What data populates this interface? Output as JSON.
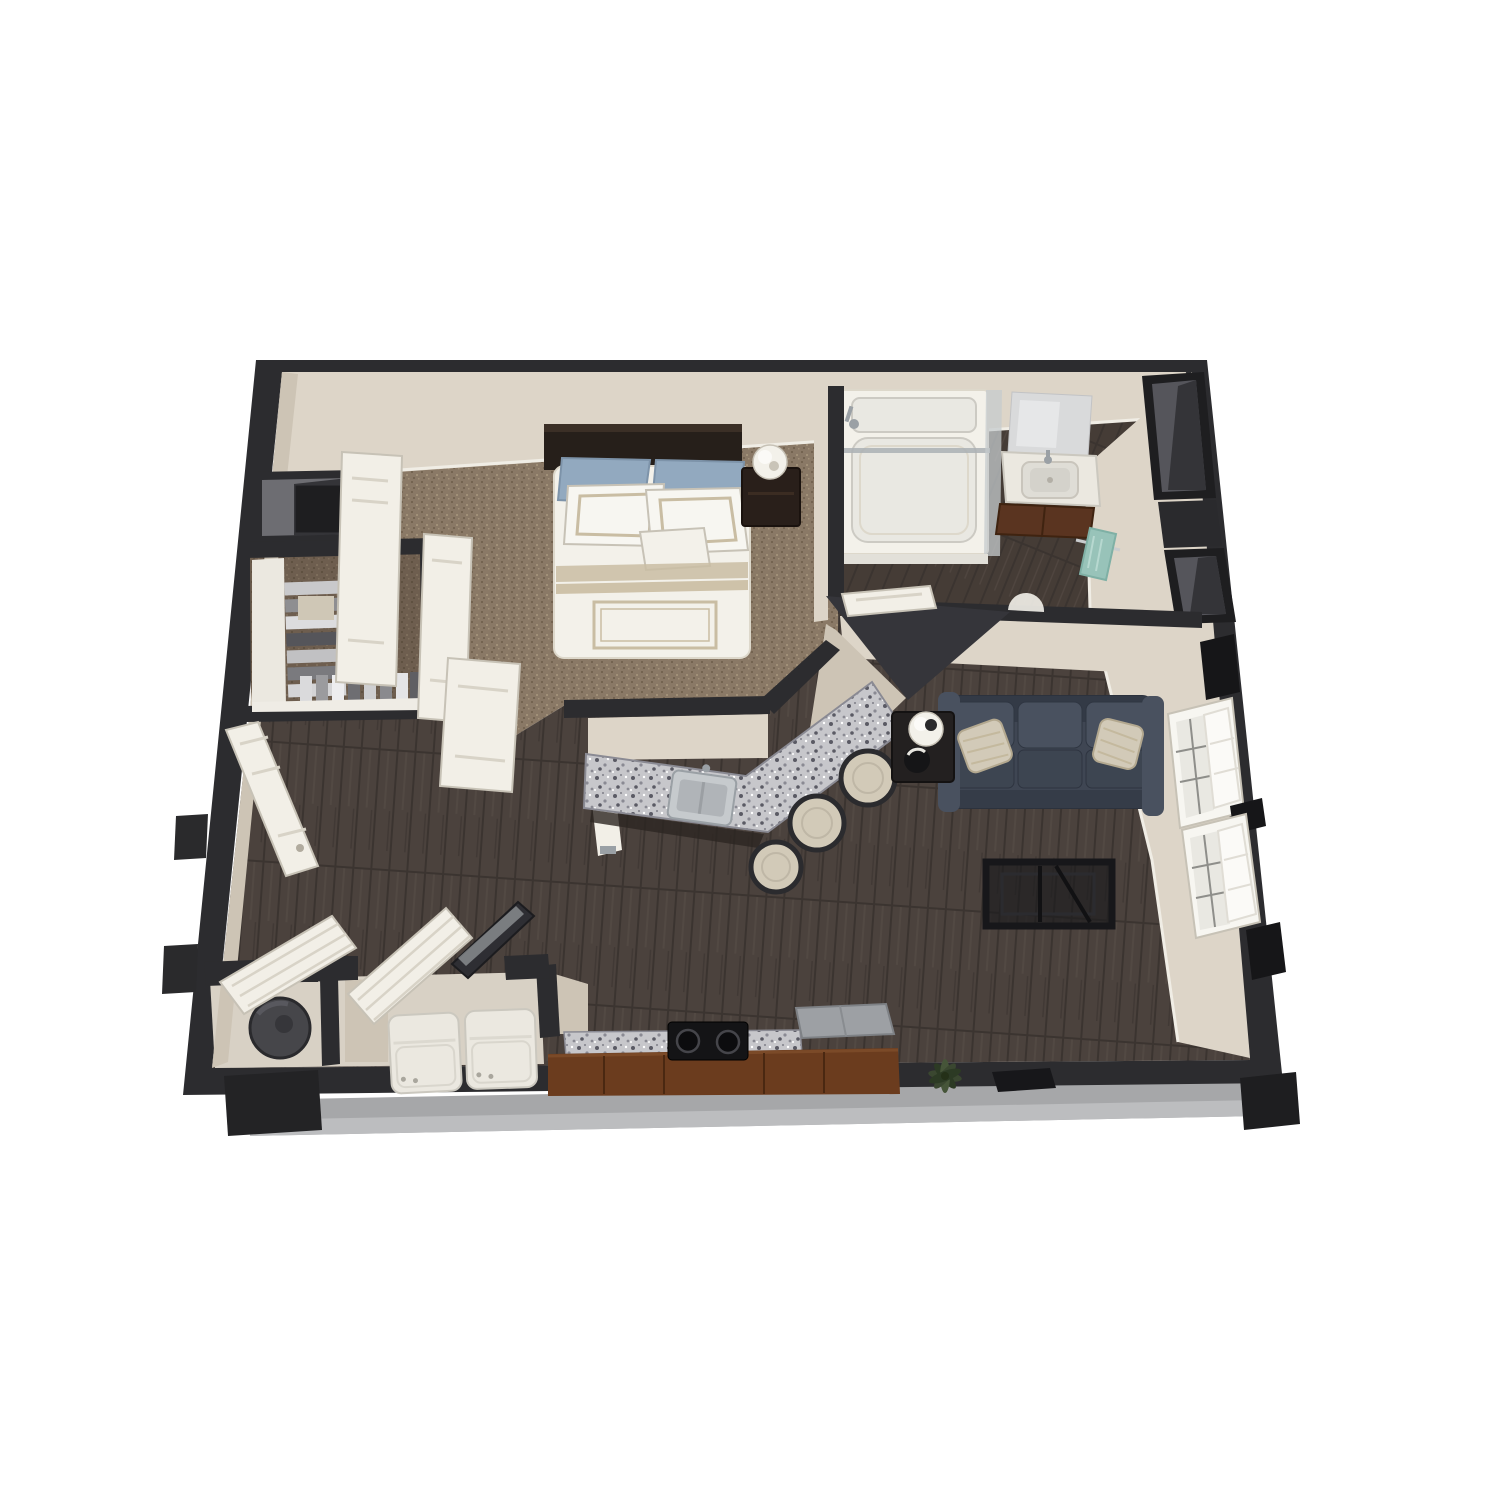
{
  "scene": {
    "type": "3d-floor-plan-render",
    "rooms": [
      "bedroom",
      "walk-in-closet",
      "bathroom",
      "kitchen",
      "living-room",
      "laundry-entry"
    ],
    "furniture": [
      "bed",
      "nightstand",
      "table-lamp",
      "closet-clothes",
      "closet-doors",
      "bathtub-shower",
      "vanity-sink",
      "mirror",
      "towel",
      "wall-niches",
      "breakfast-bar",
      "kitchen-sink",
      "bar-stools",
      "sofa",
      "throw-pillows",
      "side-table",
      "sofa-lamp",
      "decor-bowl",
      "coffee-table",
      "range",
      "refrigerator",
      "washer",
      "dryer",
      "water-heater",
      "louver-doors",
      "glass-door",
      "entry-door",
      "windows",
      "plant",
      "tv-slab",
      "entry-stoop"
    ]
  },
  "colors": {
    "wall": "#2c2c2f",
    "wallDeep": "#161618",
    "wallMid": "#35353a",
    "slab": "#a6a7a9",
    "slabLight": "#bcbdbf",
    "face": "#ddd5c8",
    "faceShade": "#cdc4b5",
    "faceFloor": "#d8d1c5",
    "baseboard": "#f0ede5",
    "doorWhite": "#f2efe7",
    "doorEdge": "#c7c2b6",
    "doorLine": "#d8d3c7",
    "carpet": "#8a7966",
    "carpetDark": "#746451",
    "carpetLight": "#a19078",
    "closetShadow": "#3a2f25",
    "wood": "#4b423d",
    "woodDark": "#3b3430",
    "woodLight": "#5a504a",
    "woodBath": "#453c36",
    "granite": "#c7c7cb",
    "graniteDark": "#5a5a64",
    "graniteMid": "#8a8a93",
    "headboard": "#261f1a",
    "headboardHi": "#3b2f26",
    "linen": "#f3f1ea",
    "linenEdge": "#ddd8cb",
    "linenTrim": "#c9bda3",
    "pillowBlue": "#92a9bf",
    "pillowBlueEdge": "#7d93a9",
    "sofa": "#3f4653",
    "sofaDark": "#333a46",
    "sofaLight": "#49515f",
    "sofaSeat": "#3d4551",
    "sofaEdge": "#2c323d",
    "pillowTan": "#d2cab8",
    "pillowTanEdge": "#b3a88f",
    "tableDark": "#232020",
    "coffeeTable": "#1a1a1d",
    "brown": "#6b3c1e",
    "brownDark": "#4a2811",
    "brownHi": "#7b4a28",
    "vanityBrown": "#5a3420",
    "steel": "#c6cacd",
    "steelMid": "#b0b4b8",
    "steelDark": "#9aa0a5",
    "towel": "#98c3b9",
    "towelEdge": "#7fb0a5",
    "appliance": "#ebe8e0",
    "applianceEdge": "#cbc8bf",
    "applianceDetail": "#a9a69d",
    "heater": "#46464a",
    "heaterEdge": "#2a2a2d",
    "nicheFrame": "#1e1e20",
    "niche": "#55555b",
    "nicheDark": "#343438",
    "nicheLight": "#6d6d72",
    "glass": "#c5cbce",
    "glassLine": "#aab0b4",
    "mirror": "#d9dadb",
    "mirrorHi": "#e6e7e8",
    "white": "#f7f6f1",
    "glazing": "#e9e8e2",
    "glazingBar": "#8e8e8a",
    "tubInner": "#e9e8e2",
    "tubLine": "#cccac3",
    "plant": "#3a4730",
    "plantDark": "#2c3a24",
    "plantLight": "#465539",
    "black": "#141416"
  }
}
